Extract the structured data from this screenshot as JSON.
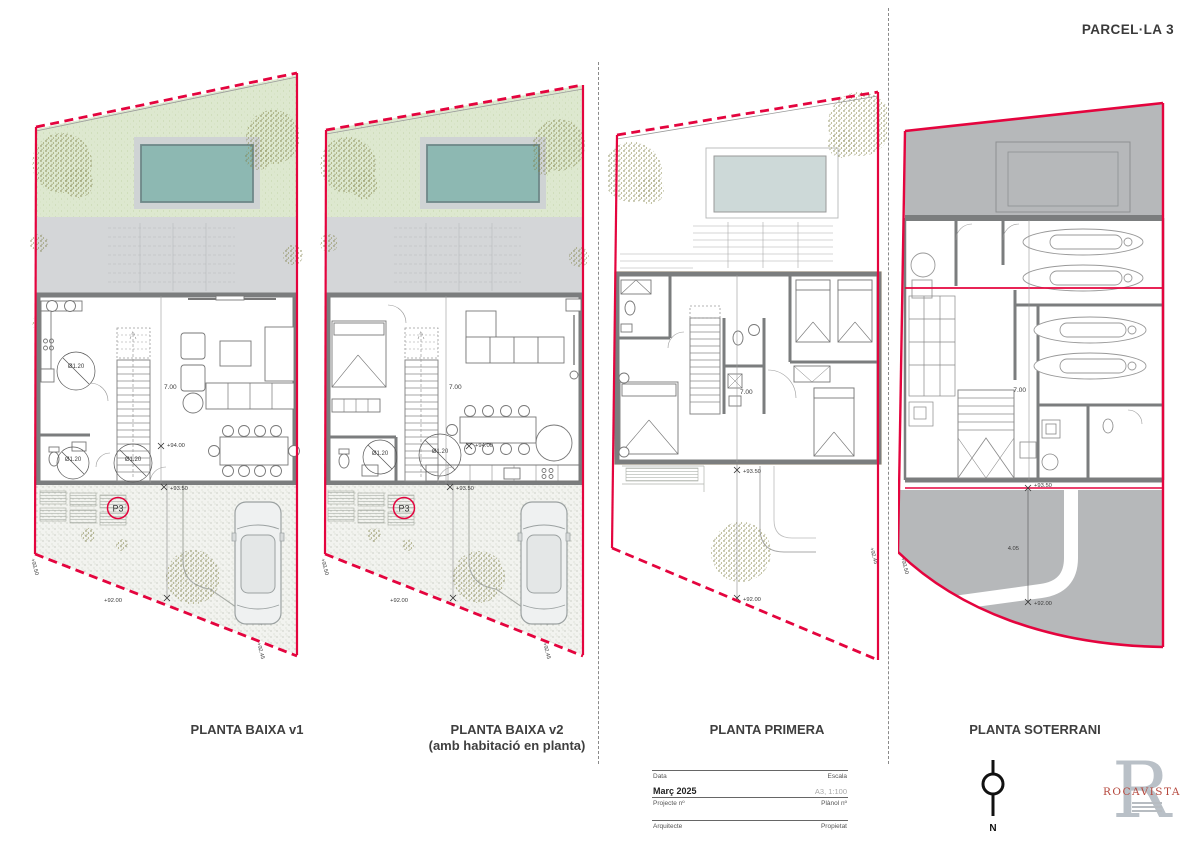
{
  "sheet_title": "PARCEL·LA 3",
  "plans": [
    {
      "label": "PLANTA BAIXA v1",
      "sublabel": ""
    },
    {
      "label": "PLANTA BAIXA v2",
      "sublabel": "(amb habitació en planta)"
    },
    {
      "label": "PLANTA PRIMERA",
      "sublabel": ""
    },
    {
      "label": "PLANTA SOTERRANI",
      "sublabel": ""
    }
  ],
  "ann": {
    "dia": "Ø1.20",
    "depth": "7.00",
    "lvl94": "+94.00",
    "lvl935": "+93.50",
    "lvl92": "+92.00",
    "lvl9245": "+92.45",
    "ramp": "4.05",
    "p3": "P3"
  },
  "titleblock": {
    "date_label": "Data",
    "scale_label": "Escala",
    "date_value": "Març 2025",
    "scale_value": "A3, 1:100",
    "project_label": "Projecte nº",
    "plan_label": "Plànol nº",
    "architect_label": "Arquitecte",
    "owner_label": "Propietat"
  },
  "north_label": "N",
  "logo": {
    "monogram": "R",
    "name": "ROCAVISTA"
  },
  "colors": {
    "boundary_red": "#e4043e",
    "garden_green": "#dde8cf",
    "pool_teal": "#8db8b2",
    "terrace_grey": "#d4d6d8",
    "wall_grey": "#7b7d7e",
    "earth_grey": "#b6b8ba",
    "house_outline_orange": "#e2a33c",
    "parking_blue": "#7b86c8"
  }
}
